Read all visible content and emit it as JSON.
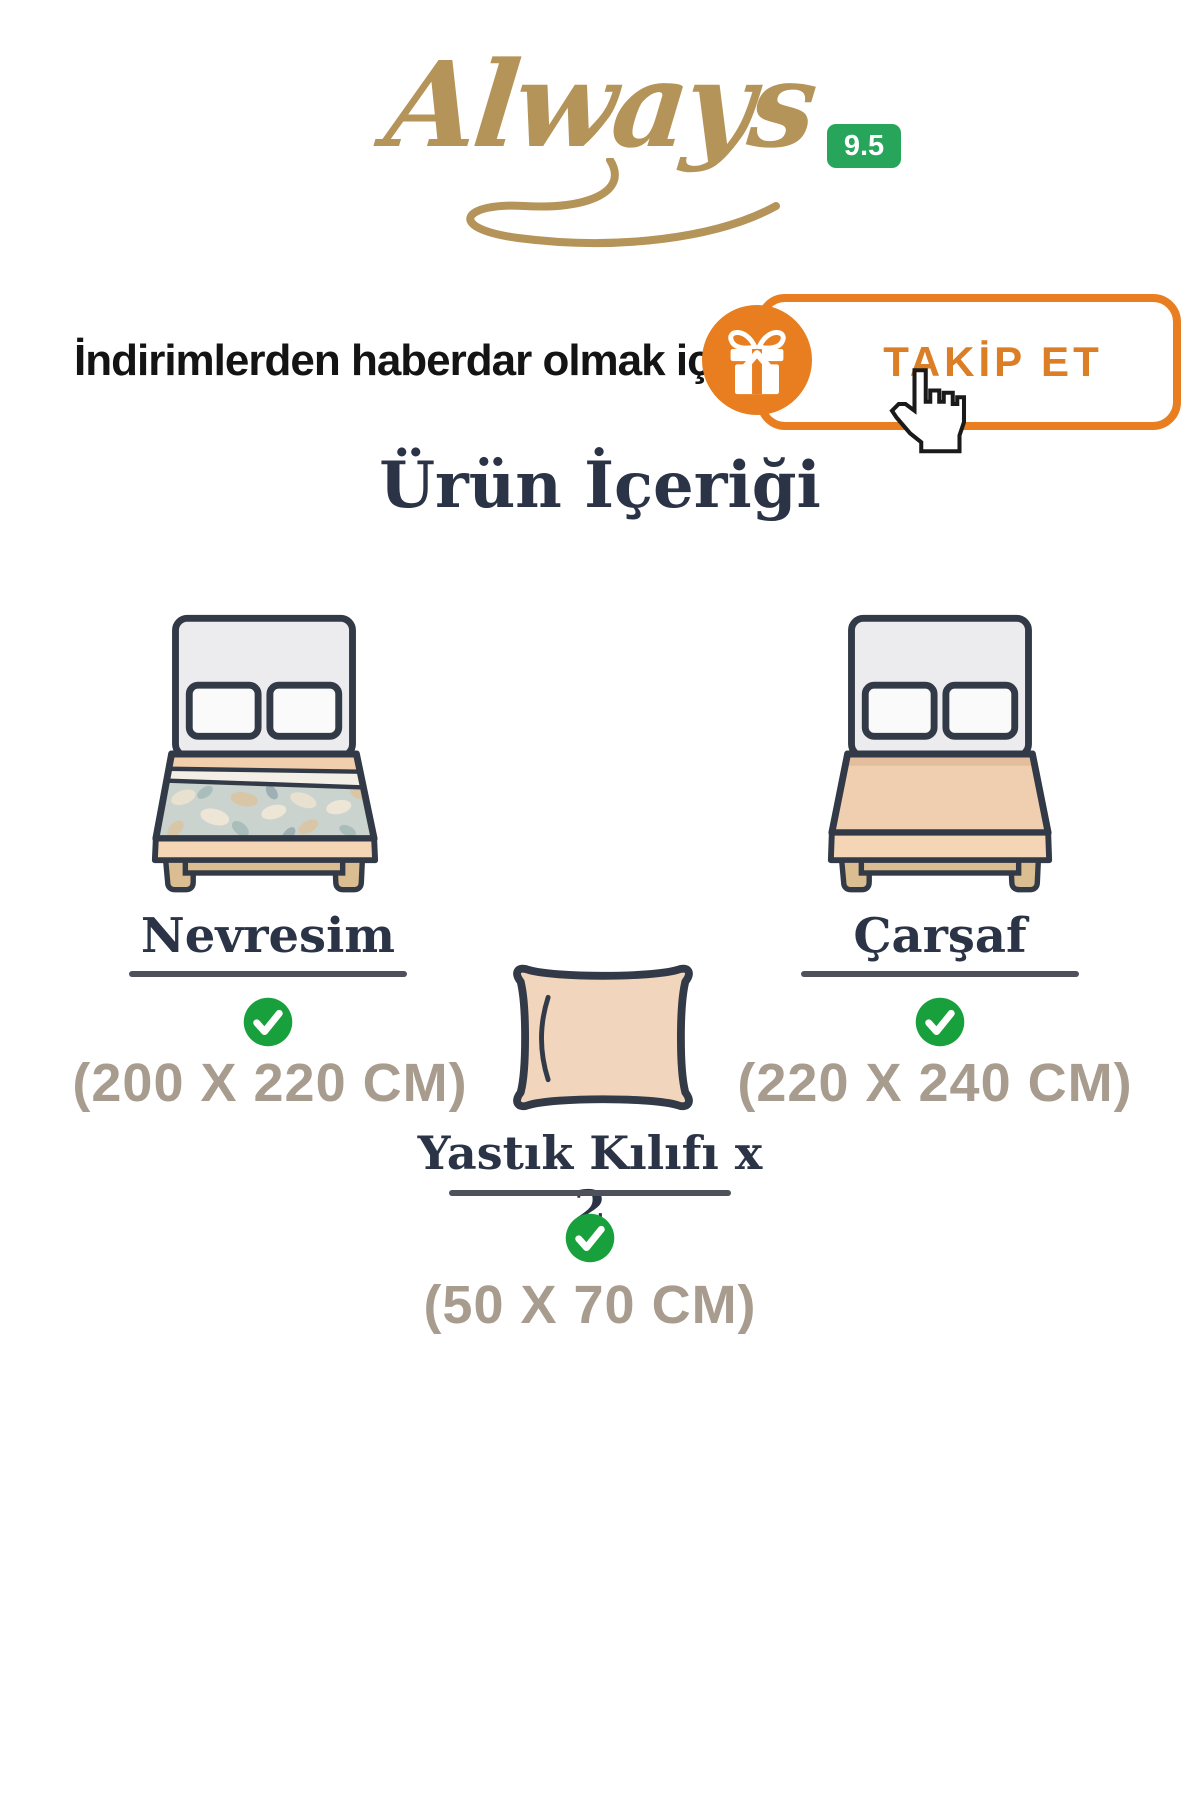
{
  "brand": {
    "name": "Always",
    "rating": "9.5"
  },
  "follow": {
    "prompt": "İndirimlerden haberdar olmak için",
    "button": "TAKİP ET"
  },
  "page": {
    "title": "Ürün İçeriği"
  },
  "items": [
    {
      "name": "Nevresim",
      "size": "(200 X 220 CM)",
      "included": true
    },
    {
      "name": "Çarşaf",
      "size": "(220 X 240 CM)",
      "included": true
    },
    {
      "name": "Yastık Kılıfı x 2",
      "size": "(50 X 70 CM)",
      "included": true
    }
  ],
  "icons": {
    "gift": "gift-icon",
    "cursor": "hand-cursor-icon",
    "check": "check-circle-icon",
    "bed_duvet": "bed-with-duvet-illustration",
    "bed_sheet": "bed-with-sheet-illustration",
    "pillow": "pillowcase-illustration"
  },
  "colors": {
    "brand_gold": "#B5945A",
    "accent_orange": "#E87E1F",
    "rating_green": "#27A65B",
    "check_green": "#18A03C",
    "heading_navy": "#2B3447",
    "size_taupe": "#A79C8E",
    "outline_dark": "#333A47",
    "peach": "#F1CEAC",
    "wood_tan": "#DABD91"
  }
}
